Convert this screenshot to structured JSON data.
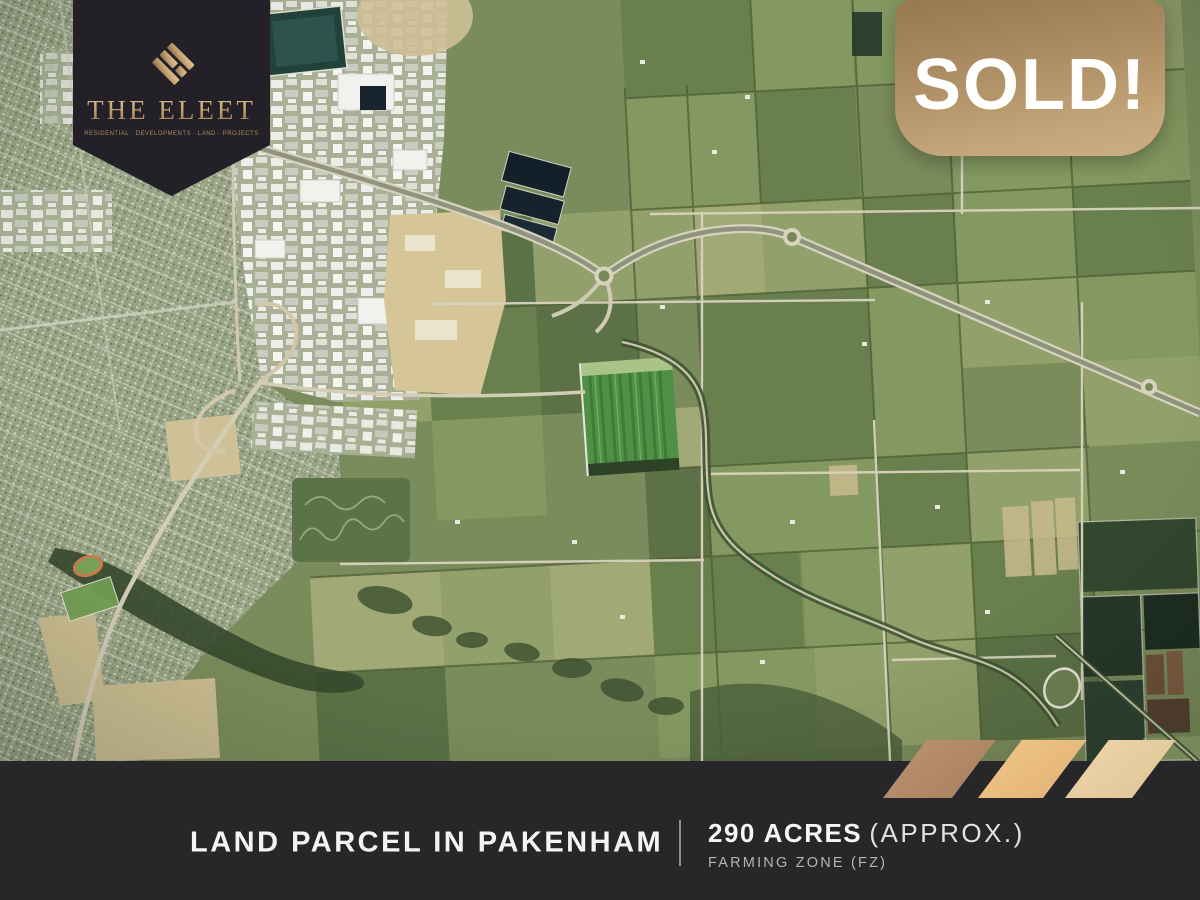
{
  "logo": {
    "title": "THE ELEET",
    "subtitle": "RESIDENTIAL · DEVELOPMENTS · LAND · PROJECTS"
  },
  "sold_badge": {
    "label": "SOLD!"
  },
  "footer": {
    "title": "LAND PARCEL IN PAKENHAM",
    "area": "290 ACRES",
    "area_note": "(APPROX.)",
    "zone": "FARMING ZONE (FZ)"
  },
  "map": {
    "description": "Aerial satellite view of farmland and Pakenham suburbs with freeway"
  },
  "colors": {
    "badge_background": "#242028",
    "bar_background": "#27272a",
    "gold_dark": "#96744a",
    "gold_light": "#e0c394",
    "sold_gradient_top": "#97784f",
    "sold_gradient_bottom": "#ccae85",
    "stripe_bronze": "#b38a68",
    "stripe_gold": "#eabd7f",
    "stripe_cream": "#e7cfa2"
  }
}
